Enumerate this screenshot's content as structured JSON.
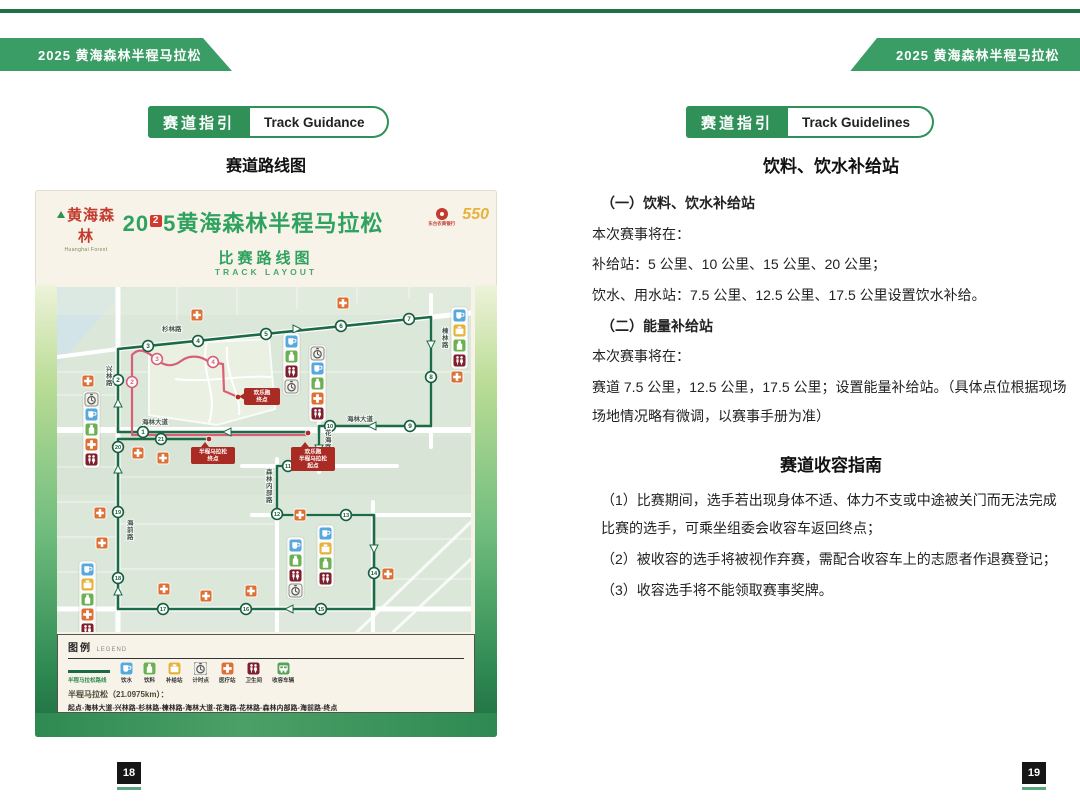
{
  "meta": {
    "banner_left": "2025 黄海森林半程马拉松",
    "banner_right": "2025 黄海森林半程马拉松"
  },
  "colors": {
    "accent_green": "#2f9058",
    "route_green": "#1b6b46",
    "route_pink": "#d95f78",
    "callout_red": "#a92b24",
    "banner_green": "#3b9d66",
    "title_green": "#2fa25f"
  },
  "left_page": {
    "badge_zh": "赛道指引",
    "badge_en": "Track Guidance",
    "heading": "赛道路线图",
    "poster": {
      "brand_zh": "黄海森林",
      "brand_en": "Huanghai Forest",
      "title_pre": "20",
      "title_box": "2",
      "title_post": "5",
      "title_zh": "黄海森林半程马拉松",
      "sponsor_bank": "东台农商银行",
      "sponsor_550": "550",
      "subtitle_zh": "比赛路线图",
      "subtitle_en": "TRACK LAYOUT"
    },
    "map": {
      "icon_colors": {
        "water": "#58a8dc",
        "drink": "#6cb052",
        "supply": "#e7b23c",
        "timer": "#f2f1ec",
        "medical": "#dd7035",
        "toilet": "#7e1f2d",
        "vehicle": "#57a257"
      },
      "green_markers": [
        {
          "n": "1",
          "x": 86,
          "y": 145
        },
        {
          "n": "2",
          "x": 61,
          "y": 93
        },
        {
          "n": "3",
          "x": 91,
          "y": 59
        },
        {
          "n": "4",
          "x": 141,
          "y": 54
        },
        {
          "n": "5",
          "x": 209,
          "y": 47
        },
        {
          "n": "6",
          "x": 284,
          "y": 39
        },
        {
          "n": "7",
          "x": 352,
          "y": 32
        },
        {
          "n": "8",
          "x": 374,
          "y": 90
        },
        {
          "n": "9",
          "x": 353,
          "y": 139
        },
        {
          "n": "10",
          "x": 273,
          "y": 139
        },
        {
          "n": "11",
          "x": 231,
          "y": 179
        },
        {
          "n": "12",
          "x": 220,
          "y": 227
        },
        {
          "n": "13",
          "x": 289,
          "y": 228
        },
        {
          "n": "14",
          "x": 317,
          "y": 286
        },
        {
          "n": "15",
          "x": 264,
          "y": 322
        },
        {
          "n": "16",
          "x": 189,
          "y": 322
        },
        {
          "n": "17",
          "x": 106,
          "y": 322
        },
        {
          "n": "18",
          "x": 61,
          "y": 291
        },
        {
          "n": "19",
          "x": 61,
          "y": 225
        },
        {
          "n": "20",
          "x": 61,
          "y": 160
        },
        {
          "n": "21",
          "x": 104,
          "y": 152
        }
      ],
      "pink_markers": [
        {
          "n": "2",
          "x": 75,
          "y": 95
        },
        {
          "n": "3",
          "x": 100,
          "y": 72
        },
        {
          "n": "4",
          "x": 156,
          "y": 75
        }
      ],
      "road_labels": [
        {
          "t": "杉林路",
          "x": 105,
          "y": 44
        },
        {
          "t": "兴林路",
          "x": 49,
          "y": 84,
          "v": 1
        },
        {
          "t": "海林大道",
          "x": 85,
          "y": 137
        },
        {
          "t": "海林大道",
          "x": 290,
          "y": 134
        },
        {
          "t": "楝林路",
          "x": 385,
          "y": 46,
          "v": 1
        },
        {
          "t": "花海路",
          "x": 268,
          "y": 148,
          "v": 1
        },
        {
          "t": "花林路",
          "x": 238,
          "y": 173
        },
        {
          "t": "森林内部路",
          "x": 209,
          "y": 187,
          "v": 1
        },
        {
          "t": "海前路",
          "x": 70,
          "y": 238,
          "v": 1
        }
      ],
      "callouts": [
        {
          "lines": [
            "欢乐跑",
            "终点"
          ],
          "x": 187,
          "y": 101,
          "w": 36,
          "h": 17,
          "side": "l"
        },
        {
          "lines": [
            "半程马拉松",
            "终点"
          ],
          "x": 134,
          "y": 160,
          "w": 44,
          "h": 17,
          "side": "t"
        },
        {
          "lines": [
            "欢乐跑",
            "半程马拉松",
            "起点"
          ],
          "x": 234,
          "y": 160,
          "w": 44,
          "h": 24,
          "side": "t"
        }
      ],
      "dots": [
        [
          251,
          146
        ],
        [
          152,
          152
        ],
        [
          181,
          110
        ]
      ],
      "icon_stacks": [
        {
          "x": 28,
          "y": 106,
          "icons": [
            "timer",
            "water",
            "drink",
            "medical",
            "toilet"
          ]
        },
        {
          "x": 228,
          "y": 48,
          "icons": [
            "water",
            "drink",
            "toilet",
            "timer"
          ]
        },
        {
          "x": 254,
          "y": 60,
          "icons": [
            "timer",
            "water",
            "drink",
            "medical",
            "toilet"
          ]
        },
        {
          "x": 396,
          "y": 22,
          "icons": [
            "water",
            "supply",
            "drink",
            "toilet"
          ]
        },
        {
          "x": 232,
          "y": 252,
          "icons": [
            "water",
            "drink",
            "toilet",
            "timer"
          ]
        },
        {
          "x": 262,
          "y": 240,
          "icons": [
            "water",
            "supply",
            "drink",
            "toilet"
          ]
        },
        {
          "x": 24,
          "y": 276,
          "icons": [
            "water",
            "supply",
            "drink",
            "medical",
            "toilet"
          ]
        }
      ],
      "crosses": [
        [
          25,
          88
        ],
        [
          134,
          22
        ],
        [
          280,
          10
        ],
        [
          394,
          84
        ],
        [
          75,
          160
        ],
        [
          100,
          165
        ],
        [
          37,
          220
        ],
        [
          39,
          250
        ],
        [
          237,
          222
        ],
        [
          325,
          281
        ],
        [
          101,
          296
        ],
        [
          143,
          303
        ],
        [
          188,
          298
        ]
      ],
      "arrows": [
        {
          "x": 170,
          "y": 145,
          "o": "l"
        },
        {
          "x": 61,
          "y": 116,
          "o": "u"
        },
        {
          "x": 240,
          "y": 42,
          "o": "r"
        },
        {
          "x": 374,
          "y": 58,
          "o": "d"
        },
        {
          "x": 315,
          "y": 139,
          "o": "l"
        },
        {
          "x": 262,
          "y": 162,
          "o": "d"
        },
        {
          "x": 317,
          "y": 262,
          "o": "d"
        },
        {
          "x": 232,
          "y": 322,
          "o": "l"
        },
        {
          "x": 61,
          "y": 304,
          "o": "u"
        },
        {
          "x": 61,
          "y": 182,
          "o": "u"
        }
      ]
    },
    "legend": {
      "title_zh": "图例",
      "title_en": "LEGEND",
      "route_sample_label": "半程马拉松路线",
      "icons": [
        {
          "key": "water",
          "label": "饮水"
        },
        {
          "key": "drink",
          "label": "饮料"
        },
        {
          "key": "supply",
          "label": "补给站"
        },
        {
          "key": "timer",
          "label": "计时点"
        },
        {
          "key": "medical",
          "label": "医疗站"
        },
        {
          "key": "toilet",
          "label": "卫生间"
        },
        {
          "key": "vehicle",
          "label": "收容车辆"
        }
      ],
      "half_title": "半程马拉松（21.0975km）：",
      "half_route": "起点-海林大道-兴林路-杉林路-楝林路-海林大道-花海路-花林路-森林内部路-海前路-终点",
      "fun_title": "欢乐跑（5km）：",
      "fun_route": "起点-海林大道-兴林路-森林内部路-森林科普馆周边"
    },
    "page_number": "18"
  },
  "right_page": {
    "badge_zh": "赛道指引",
    "badge_en": "Track Guidelines",
    "section1_title": "饮料、饮水补给站",
    "paragraphs": [
      {
        "text": "（一）饮料、饮水补给站",
        "bold": true
      },
      {
        "text": "本次赛事将在："
      },
      {
        "text": "补给站：5 公里、10 公里、15 公里、20 公里；"
      },
      {
        "text": "饮水、用水站：7.5 公里、12.5 公里、17.5 公里设置饮水补给。"
      },
      {
        "text": "（二）能量补给站",
        "bold": true
      },
      {
        "text": "本次赛事将在："
      },
      {
        "text": "赛道 7.5 公里，12.5 公里，17.5 公里；设置能量补给站。（具体点位根据现场场地情况略有微调，以赛事手册为准）"
      }
    ],
    "section2_title": "赛道收容指南",
    "paragraphs2": [
      {
        "text": "（1）比赛期间，选手若出现身体不适、体力不支或中途被关门而无法完成比赛的选手，可乘坐组委会收容车返回终点；"
      },
      {
        "text": "（2）被收容的选手将被视作弃赛，需配合收容车上的志愿者作退赛登记；"
      },
      {
        "text": "（3）收容选手将不能领取赛事奖牌。"
      }
    ],
    "page_number": "19"
  }
}
